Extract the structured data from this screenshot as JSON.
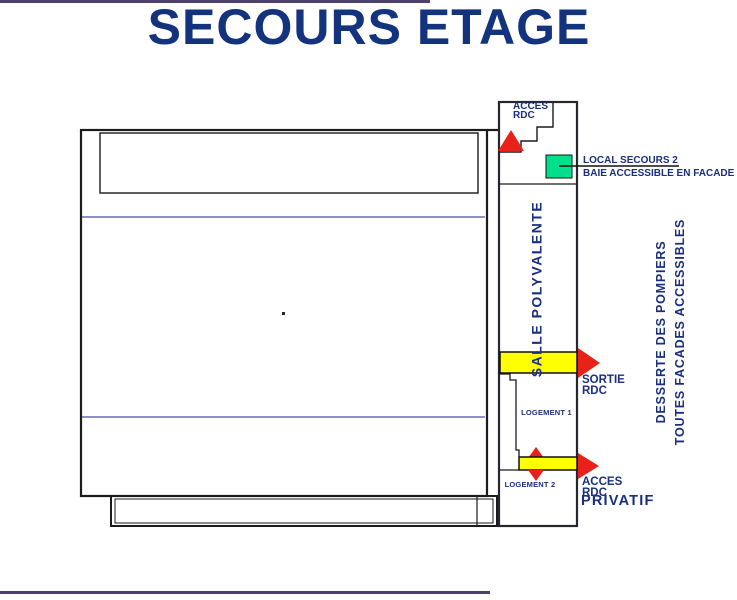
{
  "page": {
    "title": "SECOURS ETAGE"
  },
  "plan": {
    "annex": {
      "acces_rdc_top_line1": "ACCES",
      "acces_rdc_top_line2": "RDC",
      "salle_polyvalente": "SALLE POLYVALENTE",
      "logement_1": "LOGEMENT 1",
      "logement_2": "LOGEMENT 2"
    },
    "callouts": {
      "local_secours_2": "LOCAL SECOURS 2",
      "baie_accessible": "BAIE ACCESSIBLE EN FACADE",
      "sortie_line1": "SORTIE",
      "sortie_line2": "RDC",
      "acces_bottom_line1": "ACCES",
      "acces_bottom_line2": "RDC",
      "privatif": "PRIVATIF",
      "desserte_line1": "DESSERTE DES POMPIERS",
      "desserte_line2": "TOUTES FACADES ACCESSIBLES"
    },
    "colors": {
      "text_navy": "#1A2F7E",
      "title_navy": "#14337F",
      "accent_red": "#E8221A",
      "accent_yellow": "#FFFF00",
      "accent_green": "#00DF8B",
      "line_purple": "#6A6AAE",
      "frame_purple": "#4D4169",
      "line_black": "#1B1B1B"
    }
  }
}
